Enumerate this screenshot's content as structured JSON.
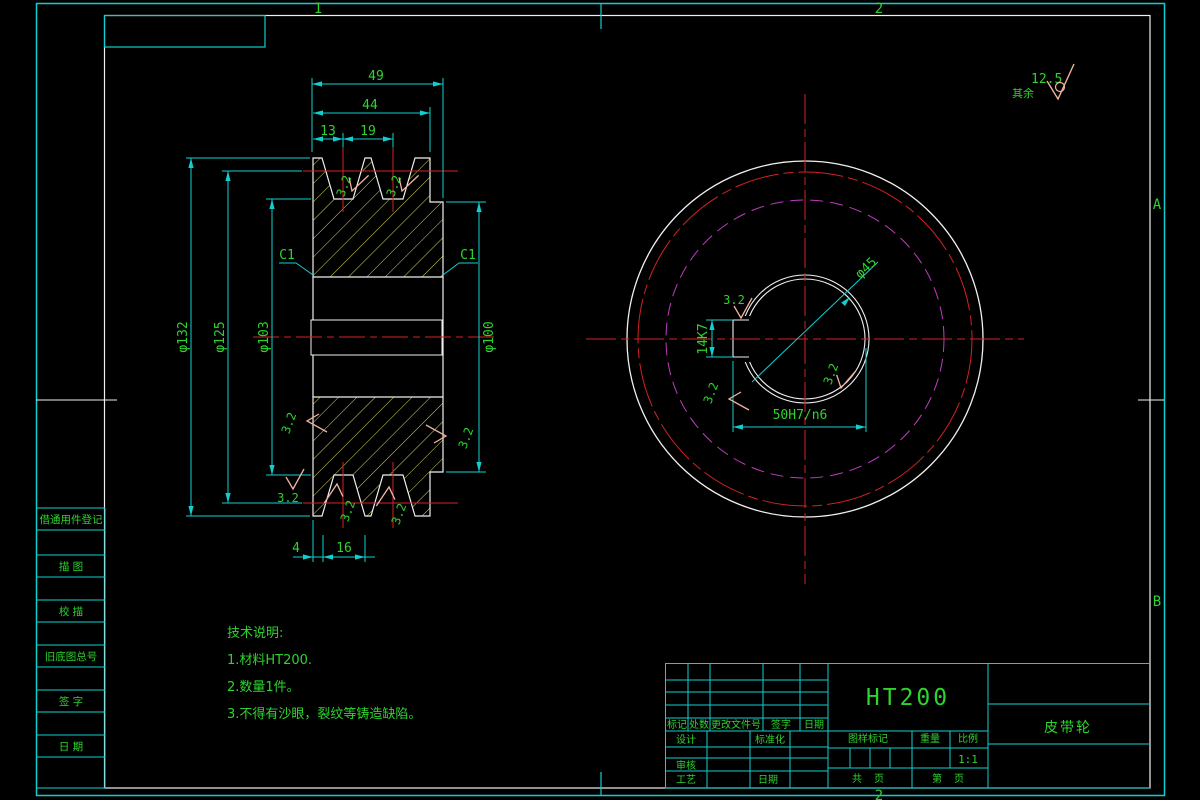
{
  "frame": {
    "zones": {
      "top1": "1",
      "top2": "2",
      "rightA": "A",
      "rightB": "B",
      "bottom2": "2"
    }
  },
  "general_roughness": {
    "prefix": "其余",
    "value": "12.5"
  },
  "roughness": {
    "value": "3.2"
  },
  "left_view": {
    "dims": {
      "w49": "49",
      "w44": "44",
      "w13": "13",
      "w19": "19",
      "d132": "φ132",
      "d125": "φ125",
      "d103": "φ103",
      "d100": "φ100",
      "chamfer": "C1",
      "b4": "4",
      "b16": "16"
    }
  },
  "right_view": {
    "dims": {
      "d45": "φ45",
      "key_w": "14K7",
      "bore_fit": "50H7/n6"
    }
  },
  "notes": {
    "heading": "技术说明:",
    "line1": "1.材料HT200.",
    "line2": "2.数量1件。",
    "line3": "3.不得有沙眼，裂纹等铸造缺陷。"
  },
  "sidebar": {
    "items": [
      {
        "label": "借通用件登记"
      },
      {
        "label": "描 图"
      },
      {
        "label": "校 描"
      },
      {
        "label": "旧底图总号"
      },
      {
        "label": "签 字"
      },
      {
        "label": "日 期"
      }
    ]
  },
  "title_block": {
    "material": "HT200",
    "part_name": "皮带轮",
    "scale_value": "1:1",
    "rev": {
      "mark": "标记",
      "count": "处数",
      "file": "更改文件号",
      "sign": "签字",
      "date": "日期"
    },
    "sig": {
      "design": "设计",
      "standard": "标准化",
      "audit": "审核",
      "process": "工艺",
      "date": "日期"
    },
    "info": {
      "mark_label": "图样标记",
      "weight_label": "重量",
      "scale_label": "比例",
      "total_label": "共",
      "page_label": "页",
      "sheet_label": "第",
      "sheet_page_label": "页"
    }
  }
}
